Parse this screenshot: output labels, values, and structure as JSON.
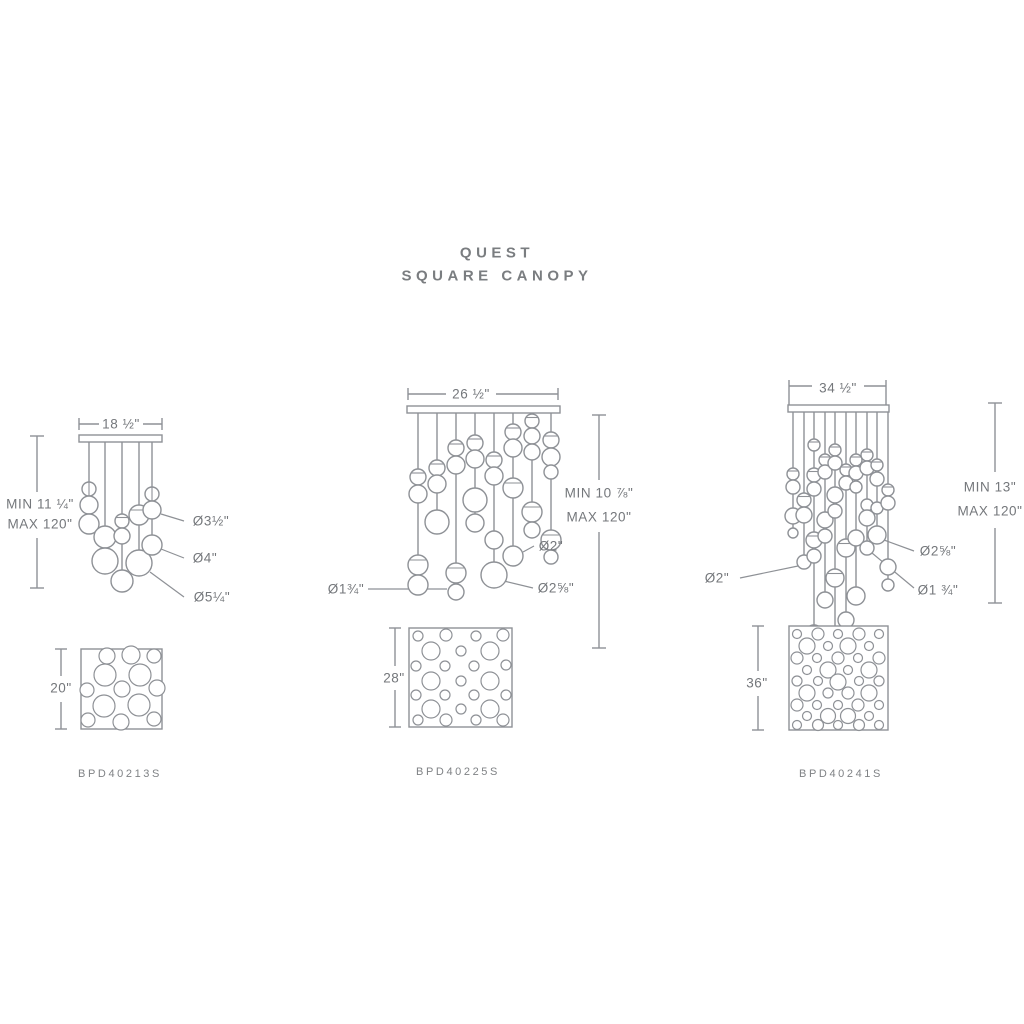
{
  "title": {
    "line1": "QUEST",
    "line2": "SQUARE CANOPY"
  },
  "fixtures": [
    {
      "name": "13-light square canopy pendant",
      "canopy_width": "18 ½\"",
      "min_height": "MIN 11 ¼\"",
      "max_height": "MAX 120\"",
      "diameter_labels": [
        "Ø3½\"",
        "Ø4\"",
        "Ø5¼\""
      ],
      "canopy_size": "20\"",
      "model": "BPD40213S"
    },
    {
      "name": "25-light square canopy pendant",
      "canopy_width": "26 ½\"",
      "min_height": "MIN 10 ⅞\"",
      "max_height": "MAX 120\"",
      "diameter_labels": [
        "Ø2\"",
        "Ø1¾\"",
        "Ø2⅝\""
      ],
      "canopy_size": "28\"",
      "model": "BPD40225S"
    },
    {
      "name": "41-light square canopy pendant",
      "canopy_width": "34 ½\"",
      "min_height": "MIN 13\"",
      "max_height": "MAX 120\"",
      "diameter_labels": [
        "Ø2\"",
        "Ø2⅝\"",
        "Ø1 ¾\""
      ],
      "canopy_size": "36\"",
      "model": "BPD40241S"
    }
  ],
  "colors": {
    "line": "#8E9196",
    "text": "#74777B",
    "background": "#FFFFFF"
  }
}
